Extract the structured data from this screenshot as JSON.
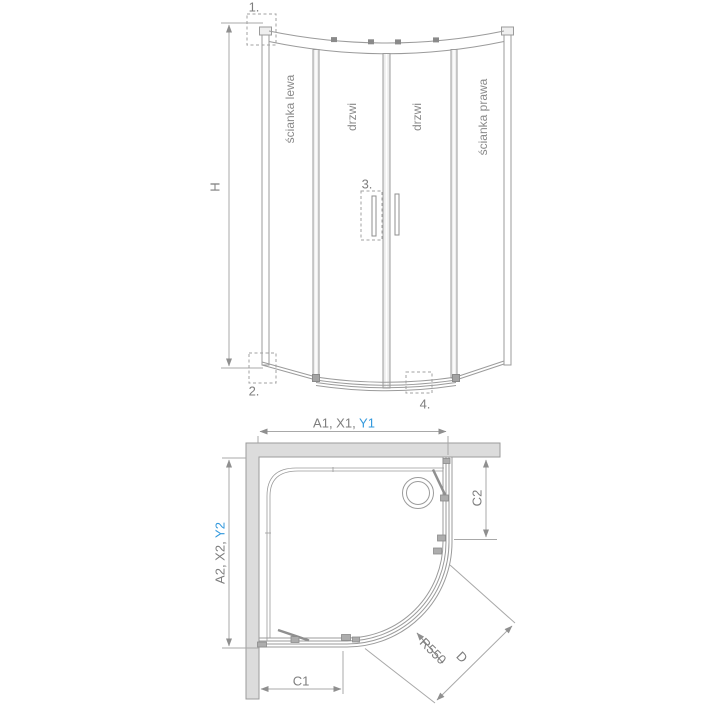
{
  "front_view": {
    "callout_1": "1.",
    "callout_2": "2.",
    "callout_3": "3.",
    "callout_4": "4.",
    "height_label": "H",
    "panel_left": "ścianka lewa",
    "door_left": "drzwi",
    "door_right": "drzwi",
    "panel_right": "ścianka prawa"
  },
  "plan_view": {
    "width_dim_prefix": "A1, X1, ",
    "width_dim_highlight": "Y1",
    "depth_dim_prefix": "A2, X2, ",
    "depth_dim_highlight": "Y2",
    "c1_label": "C1",
    "c2_label": "C2",
    "radius_label": "R550",
    "diagonal_label": "D"
  },
  "colors": {
    "line": "#9b9b9b",
    "text": "#7e7e7e",
    "panel_text": "#8a8a8a",
    "highlight": "#3399dd",
    "wall_fill": "#dcdcdc"
  }
}
